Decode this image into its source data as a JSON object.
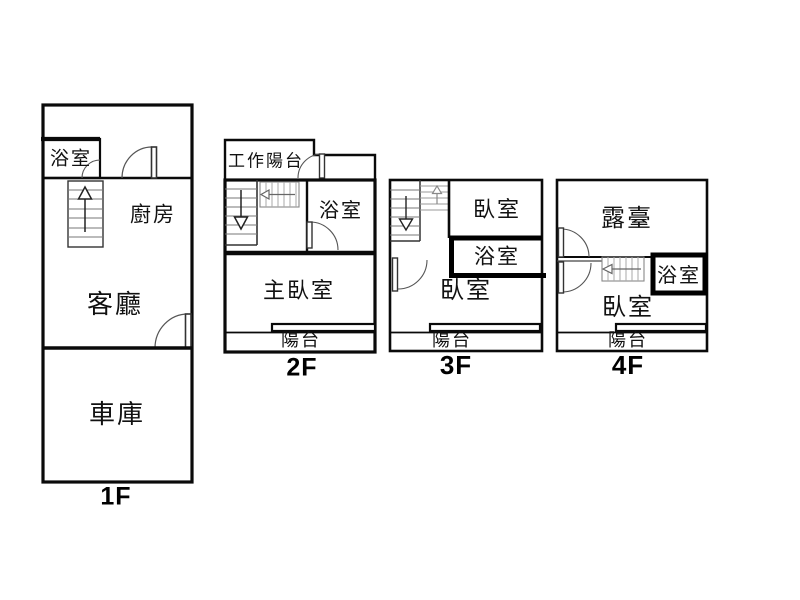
{
  "diagram_type": "floor-plan",
  "colors": {
    "wall": "#000000",
    "background": "#ffffff",
    "stair_tread": "#777777"
  },
  "floors": {
    "f1": {
      "label": "1F",
      "rooms": {
        "bathroom": "浴室",
        "kitchen": "廚房",
        "living_room": "客廳",
        "garage": "車庫"
      }
    },
    "f2": {
      "label": "2F",
      "rooms": {
        "work_balcony": "工作陽台",
        "bathroom": "浴室",
        "master_bedroom": "主臥室",
        "balcony": "陽台"
      }
    },
    "f3": {
      "label": "3F",
      "rooms": {
        "bedroom_upper": "臥室",
        "bathroom": "浴室",
        "bedroom": "臥室",
        "balcony": "陽台"
      }
    },
    "f4": {
      "label": "4F",
      "rooms": {
        "terrace": "露臺",
        "bathroom": "浴室",
        "bedroom": "臥室",
        "balcony": "陽台"
      }
    }
  }
}
